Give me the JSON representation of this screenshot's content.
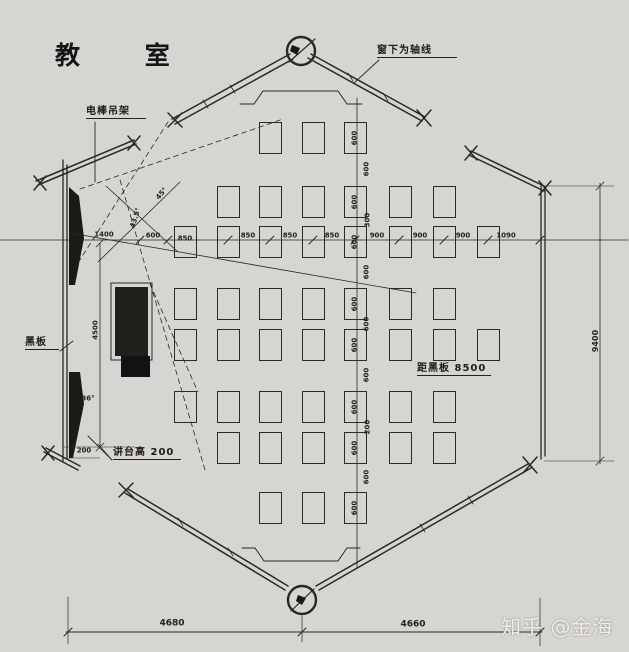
{
  "plan": {
    "title": {
      "text": "教 室"
    },
    "watermark": {
      "text": "知乎 @金海"
    },
    "colors": {
      "paper": "#d7d5d1",
      "ink": "#2a2823",
      "platform_fill": "#1f1d1a"
    },
    "annotations": [
      {
        "id": "light-rack-label",
        "text": "电棒吊架",
        "x": 86,
        "y": 106,
        "w": 60
      },
      {
        "id": "window-axis-label",
        "text": "窗下为轴线",
        "x": 377,
        "y": 45,
        "w": 80
      },
      {
        "id": "blackboard-label",
        "text": "黑板",
        "x": 25,
        "y": 337,
        "w": 34
      },
      {
        "id": "platform-height-label",
        "text": "讲台高 200",
        "x": 113,
        "y": 447,
        "w": 68
      },
      {
        "id": "last-row-label",
        "text": "距黑板 8500",
        "x": 417,
        "y": 363,
        "w": 74
      }
    ],
    "dims": [
      {
        "t": "1400",
        "x": 104,
        "y": 235
      },
      {
        "t": "600",
        "x": 153,
        "y": 236
      },
      {
        "t": "850",
        "x": 185,
        "y": 239
      },
      {
        "t": "850",
        "x": 248,
        "y": 236
      },
      {
        "t": "850",
        "x": 290,
        "y": 236
      },
      {
        "t": "850",
        "x": 332,
        "y": 236
      },
      {
        "t": "900",
        "x": 377,
        "y": 236
      },
      {
        "t": "900",
        "x": 420,
        "y": 236
      },
      {
        "t": "900",
        "x": 463,
        "y": 236
      },
      {
        "t": "1090",
        "x": 506,
        "y": 236
      },
      {
        "t": "600",
        "x": 355,
        "y": 138,
        "r": -90
      },
      {
        "t": "600",
        "x": 355,
        "y": 202,
        "r": -90
      },
      {
        "t": "600",
        "x": 355,
        "y": 242,
        "r": -90
      },
      {
        "t": "600",
        "x": 355,
        "y": 304,
        "r": -90
      },
      {
        "t": "600",
        "x": 355,
        "y": 345,
        "r": -90
      },
      {
        "t": "600",
        "x": 355,
        "y": 407,
        "r": -90
      },
      {
        "t": "600",
        "x": 355,
        "y": 448,
        "r": -90
      },
      {
        "t": "600",
        "x": 355,
        "y": 508,
        "r": -90
      },
      {
        "t": "600",
        "x": 367,
        "y": 169,
        "r": -90
      },
      {
        "t": "300",
        "x": 368,
        "y": 220,
        "r": -90
      },
      {
        "t": "600",
        "x": 367,
        "y": 272,
        "r": -90
      },
      {
        "t": "600",
        "x": 367,
        "y": 324,
        "r": -90
      },
      {
        "t": "600",
        "x": 367,
        "y": 375,
        "r": -90
      },
      {
        "t": "200",
        "x": 368,
        "y": 427,
        "r": -90
      },
      {
        "t": "600",
        "x": 367,
        "y": 477,
        "r": -90
      },
      {
        "t": "9400",
        "x": 596,
        "y": 341,
        "r": -90,
        "fs": 8
      },
      {
        "t": "4500",
        "x": 96,
        "y": 330,
        "r": -90
      },
      {
        "t": "200",
        "x": 84,
        "y": 451
      },
      {
        "t": "4680",
        "x": 172,
        "y": 624,
        "fs": 9
      },
      {
        "t": "4660",
        "x": 413,
        "y": 625,
        "fs": 9
      },
      {
        "t": "36°",
        "x": 88,
        "y": 399
      },
      {
        "t": "45°",
        "x": 162,
        "y": 194,
        "r": -50
      },
      {
        "t": "43.5°",
        "x": 136,
        "y": 218,
        "r": -72
      }
    ],
    "desks": {
      "w": 23,
      "h": 32,
      "cols": [
        174,
        217,
        259,
        302,
        344,
        389,
        433,
        477
      ],
      "rows": [
        122,
        186,
        226,
        288,
        329,
        391,
        432,
        492
      ],
      "present": [
        [
          2,
          3,
          4
        ],
        [
          1,
          2,
          3,
          4,
          5,
          6
        ],
        [
          0,
          1,
          2,
          3,
          4,
          5,
          6,
          7
        ],
        [
          0,
          1,
          2,
          3,
          4,
          5,
          6
        ],
        [
          0,
          1,
          2,
          3,
          4,
          5,
          6,
          7
        ],
        [
          0,
          1,
          2,
          3,
          4,
          5,
          6
        ],
        [
          1,
          2,
          3,
          4,
          5,
          6
        ],
        [
          2,
          3,
          4
        ]
      ]
    }
  }
}
